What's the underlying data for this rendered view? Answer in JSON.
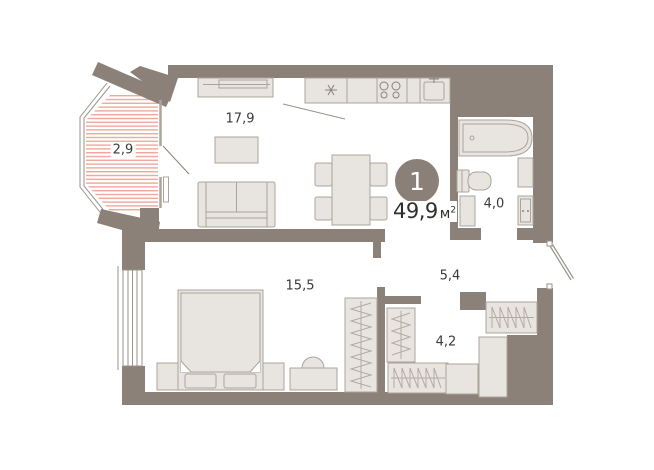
{
  "plan": {
    "badge": {
      "rooms_count": "1"
    },
    "total_area": {
      "value": "49,9",
      "unit": "м",
      "unit_sup": "2"
    },
    "rooms": [
      {
        "id": "balcony",
        "area": "2,9"
      },
      {
        "id": "living-kitchen",
        "area": "17,9"
      },
      {
        "id": "bathroom",
        "area": "4,0"
      },
      {
        "id": "hallway",
        "area": "5,4"
      },
      {
        "id": "wardrobe-room",
        "area": "4,2"
      },
      {
        "id": "bedroom",
        "area": "15,5"
      }
    ],
    "colors": {
      "wall": "#8b8179",
      "furniture_fill": "#e8e4e0",
      "furniture_stroke": "#aca49b",
      "balcony_hatch": "#f0a89d",
      "badge": "#8a8078",
      "badge_text": "#ffffff",
      "text": "#3a3a38"
    }
  }
}
